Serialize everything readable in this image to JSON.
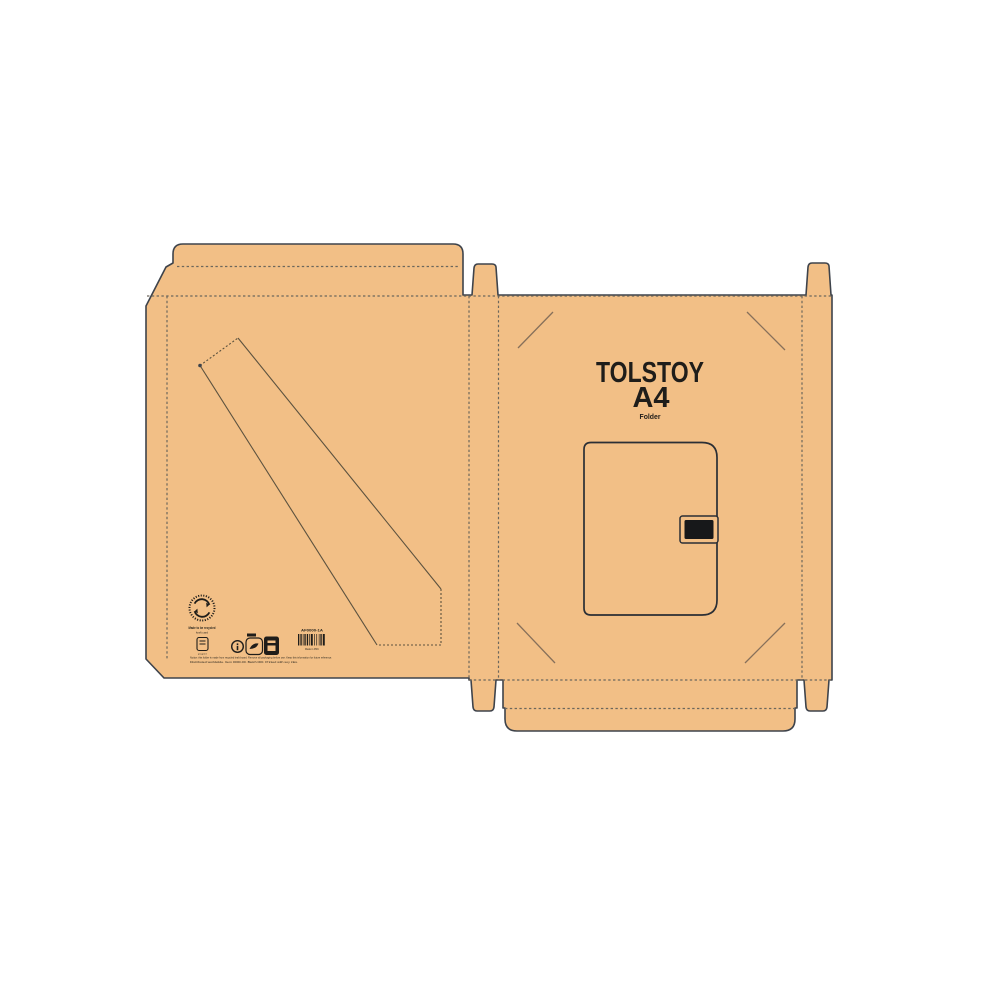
{
  "canvas": {
    "background": "#ffffff",
    "kraft_color": "#f2bf86",
    "cut_line_color": "#3e434b",
    "fold_line_color": "#6d675c",
    "corner_mark_color": "#87705a",
    "ink_color": "#1f1d1a"
  },
  "front_panel": {
    "title_line1": "TOLSTOY",
    "title_line2": "A4",
    "subtitle": "Folder"
  },
  "back_panel": {
    "recycle_caption_line1": "Made to be recycled",
    "recycle_caption_line2": "kraft card",
    "paper_icon_caption": "paper",
    "barcode": {
      "label_top": "AF0000-1A",
      "label_bottom": "Made in PRC",
      "pattern": "212111212111311212112131"
    },
    "microprint_line1": "Notice: this folder is made from recycled kraft board. Remove all packaging before use. Keep this information for future reference.",
    "microprint_line2": "Distributed worldwide. Item 0000-00. Batch 000. Printed with soy inks."
  }
}
